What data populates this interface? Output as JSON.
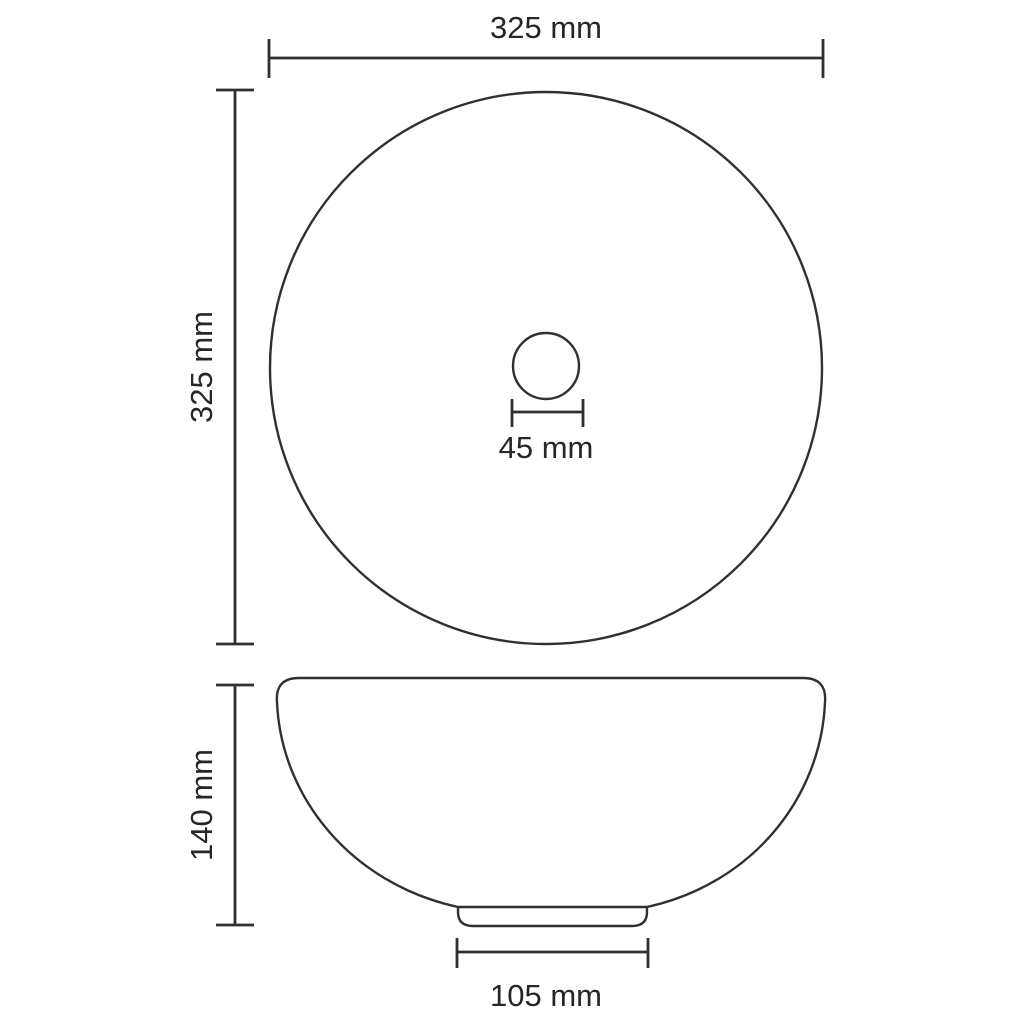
{
  "canvas": {
    "width": 1024,
    "height": 1024,
    "background": "#ffffff"
  },
  "style": {
    "line_color": "#303030",
    "text_color": "#262626"
  },
  "dimensions": {
    "overall_width": {
      "label": "325 mm",
      "value": 325,
      "unit": "mm"
    },
    "overall_depth": {
      "label": "325 mm",
      "value": 325,
      "unit": "mm"
    },
    "drain_diameter": {
      "label": "45 mm",
      "value": 45,
      "unit": "mm"
    },
    "overall_height": {
      "label": "140 mm",
      "value": 140,
      "unit": "mm"
    },
    "base_diameter": {
      "label": "105 mm",
      "value": 105,
      "unit": "mm"
    }
  }
}
